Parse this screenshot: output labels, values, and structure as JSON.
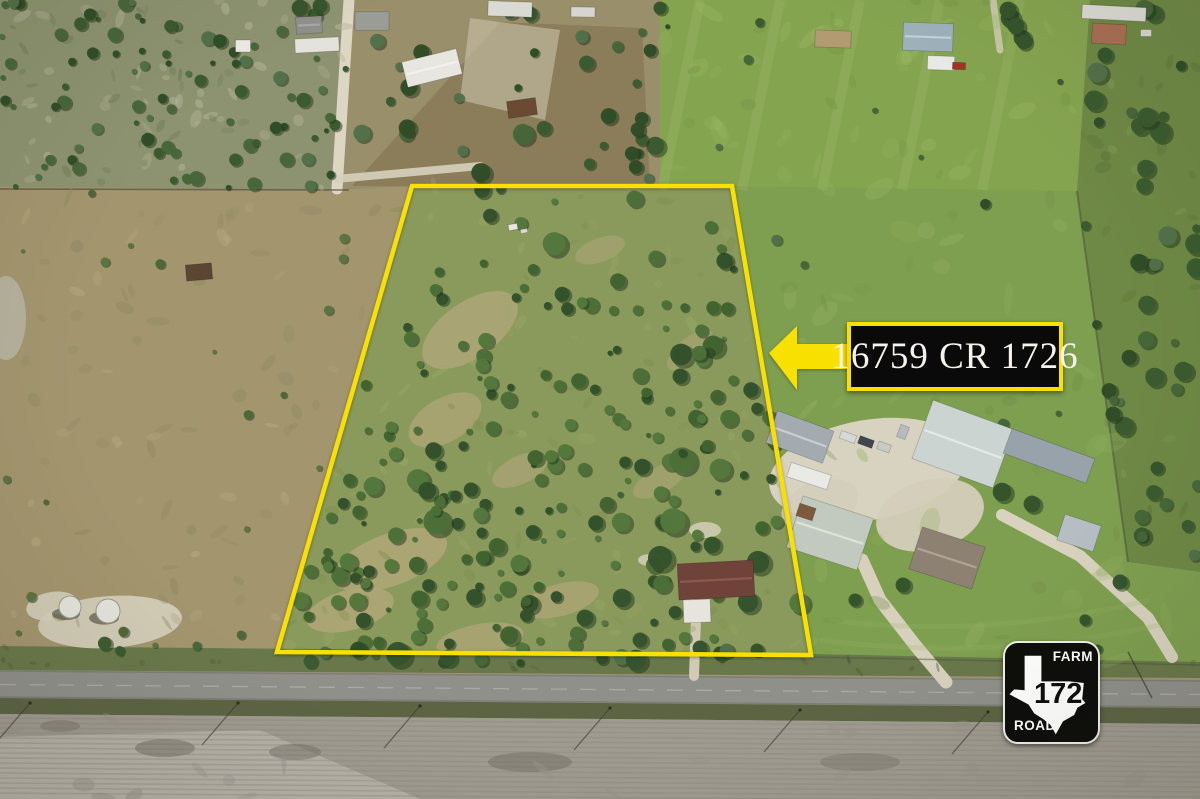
{
  "image": {
    "kind": "aerial-drone-photo",
    "caption": "Aerial view of rural acreage with highlighted lot lines along a farm road"
  },
  "annotations": {
    "address_callout": {
      "text": "16759 CR 1726",
      "bg_color": "#0a0a0a",
      "border_color": "#f8e000",
      "text_color": "#f5f3ec"
    },
    "pointer_arrow": {
      "color": "#f8e000",
      "direction": "left"
    },
    "property_boundary": {
      "color": "#f8e000"
    },
    "road_sign": {
      "top_label": "FARM",
      "route_number": "1726",
      "bottom_label": "ROAD",
      "bg_color": "#0d0d0b",
      "fg_color": "#ffffff",
      "icon": "texas-state-icon"
    }
  }
}
